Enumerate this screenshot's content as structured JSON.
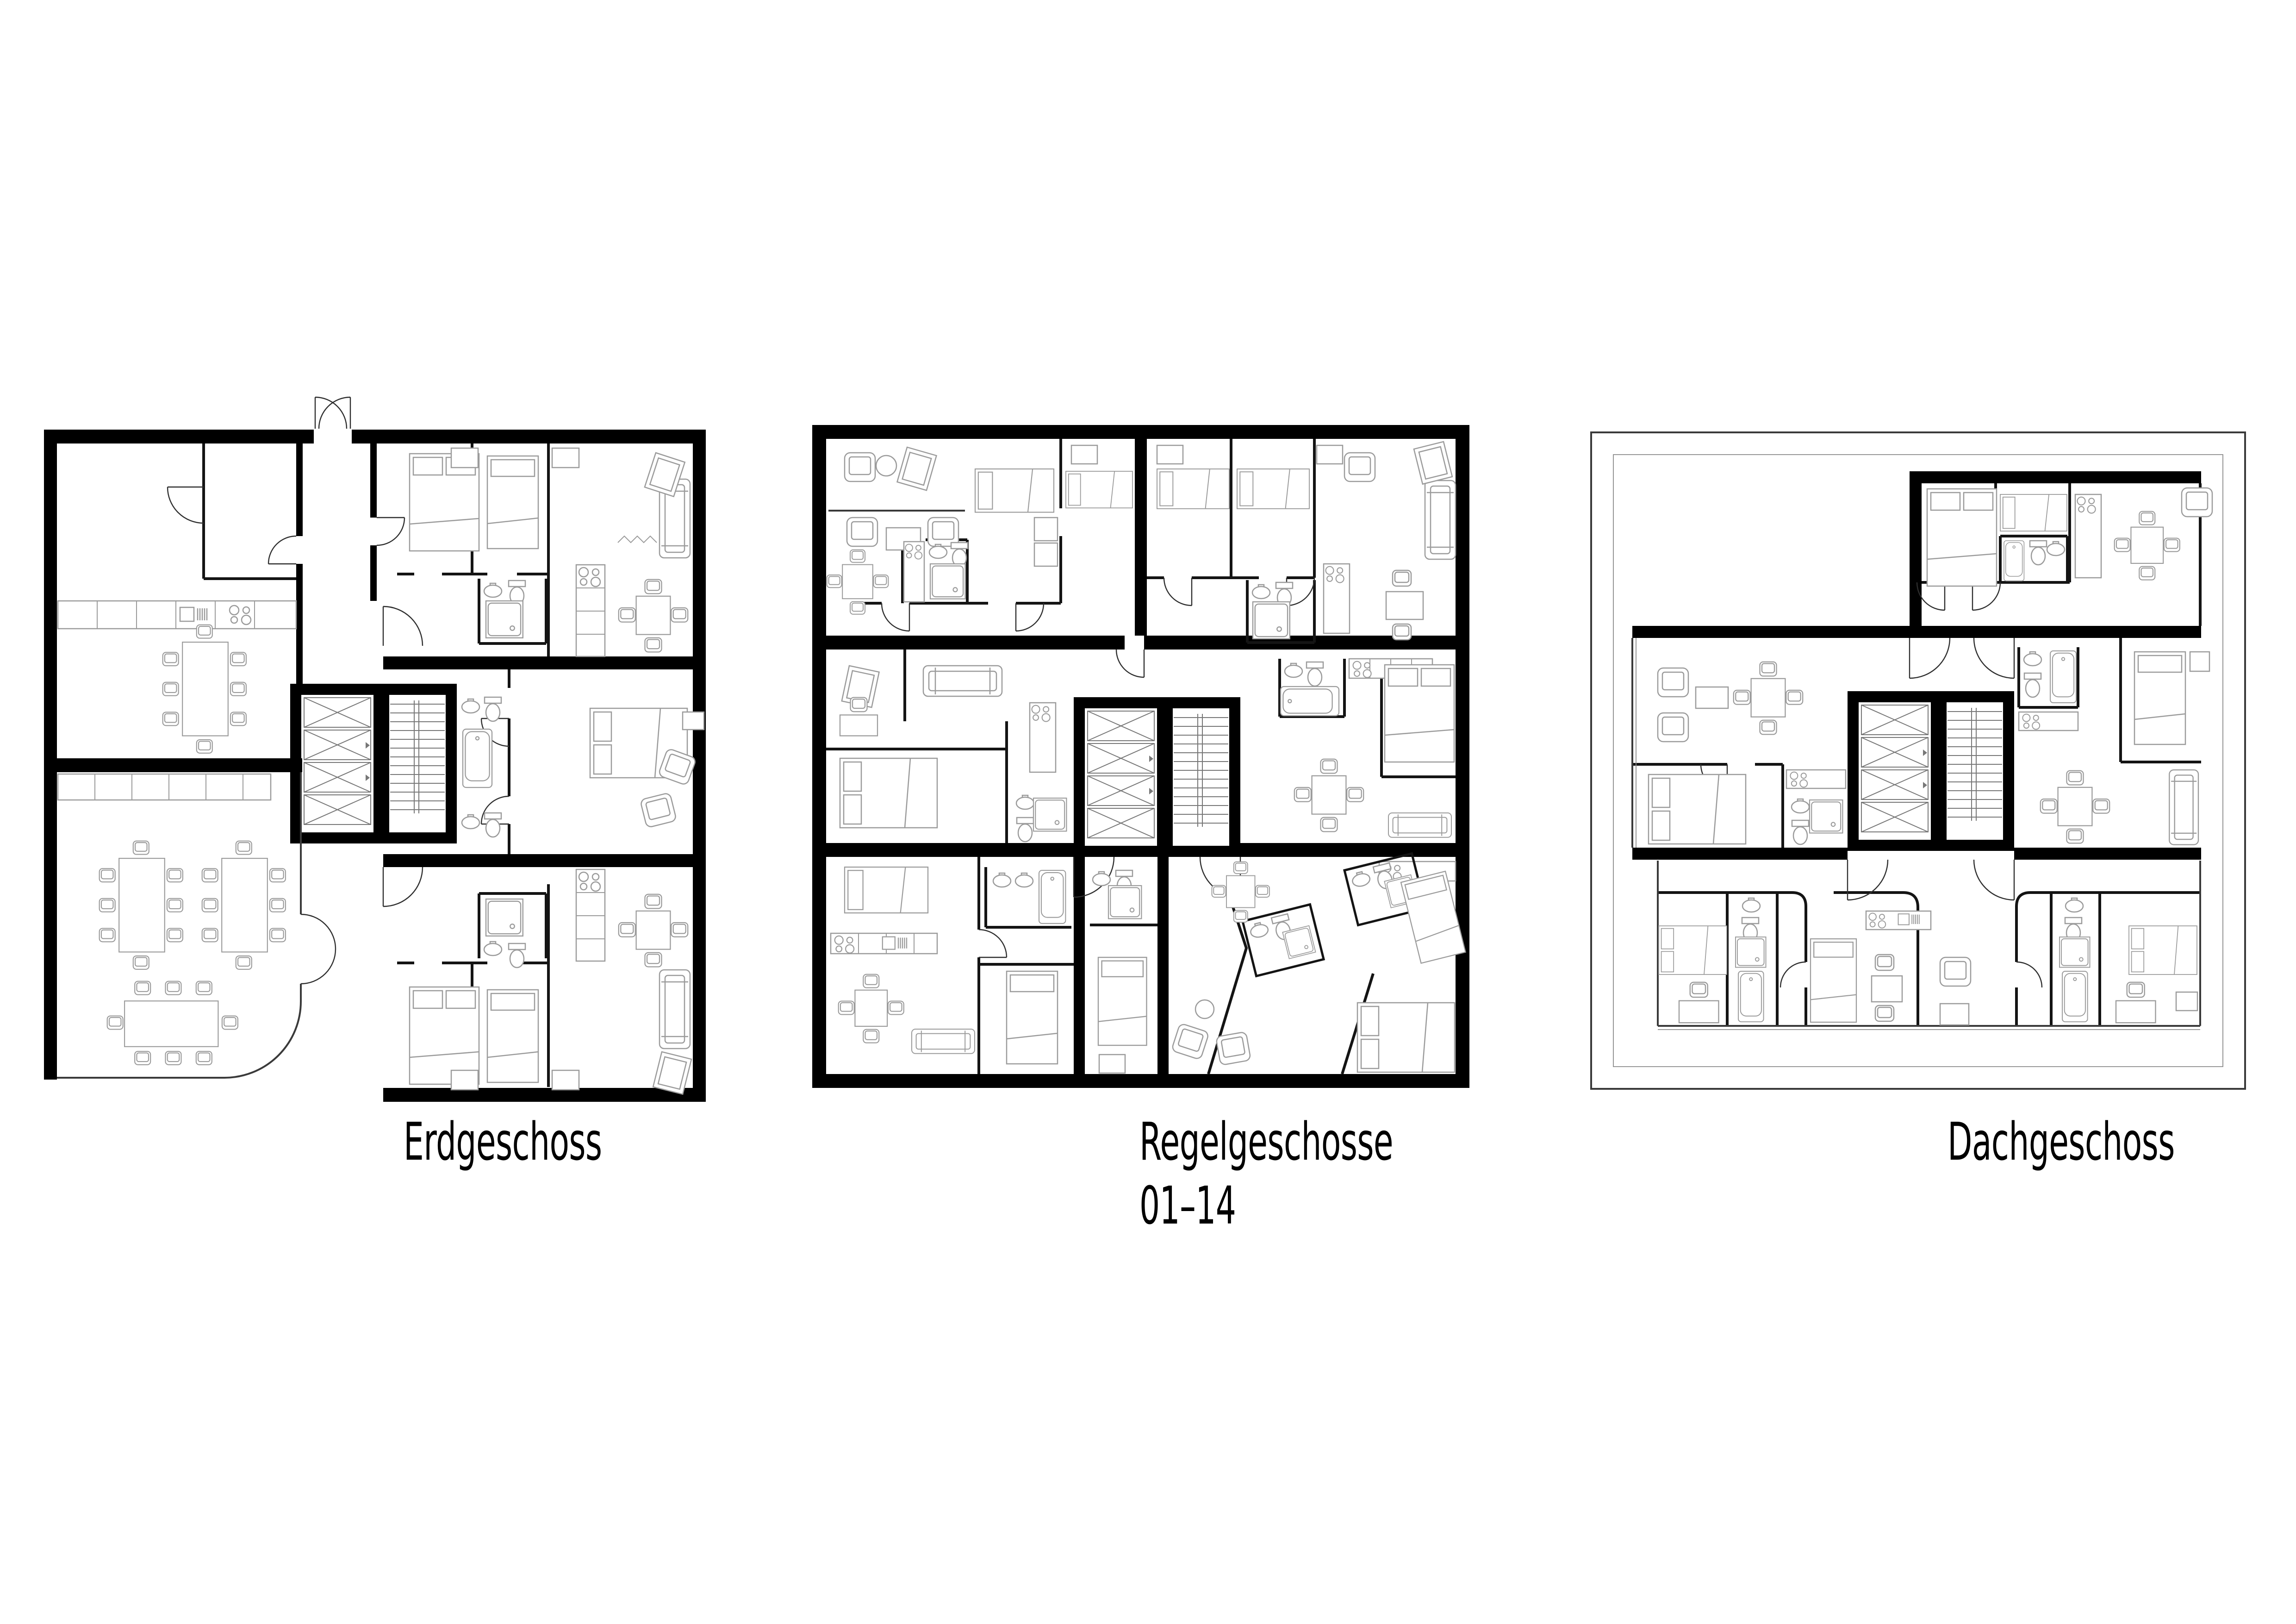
{
  "background": "#ffffff",
  "ink": {
    "wall": "#000000",
    "partition": "#141414",
    "furniture": "#9b9b9b",
    "door_arc": "#2e2e2e",
    "core_detail": "#777777"
  },
  "plans": [
    {
      "id": "erdgeschoss",
      "label": "Erdgeschoss",
      "core": {
        "elevator_shafts": 4,
        "stairwell": true
      },
      "entrance": "double swing door at top center",
      "features": [
        "two large common rooms with dining tables on the left",
        "curved glass corner at lower left",
        "apartments on the right"
      ]
    },
    {
      "id": "regelgeschosse",
      "label_line1": "Regelgeschosse",
      "label_line2": "01–14",
      "core": {
        "elevator_shafts": 4,
        "stairwell": true
      },
      "features": [
        "square typical floor fully enclosed by thick walls",
        "apartments on all sides",
        "angled bathroom pods in lower-right unit"
      ]
    },
    {
      "id": "dachgeschoss",
      "label": "Dachgeschoss",
      "core": {
        "elevator_shafts": 4,
        "stairwell": true
      },
      "perimeter": "thin roof-terrace outline around set-back penthouse",
      "features": [
        "set-back upper block at top right",
        "terrace border drawn as thin double line"
      ]
    }
  ]
}
